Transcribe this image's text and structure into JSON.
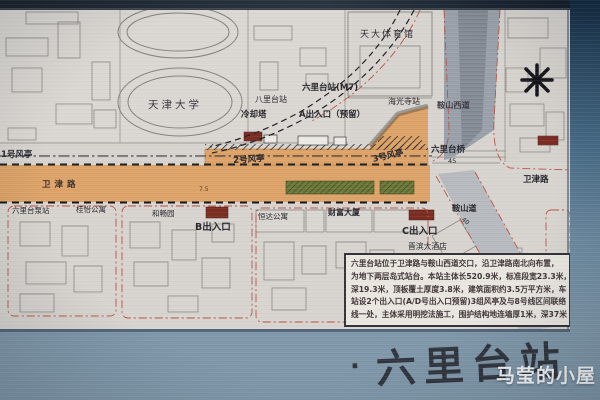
{
  "board": {
    "title_bullet": "·",
    "station_title": "六里台站",
    "watermark": "马莹的小屋"
  },
  "map": {
    "labels": {
      "tju_gym": "天大体育馆",
      "tianjin_university": "天津大学",
      "balitai_station": "八里台站",
      "liulitai_station": "六里台站(M7)",
      "haiguangsi_station": "海光寺站",
      "cooling_tower": "冷却塔",
      "entrance_a": "A出入口（预留）",
      "vent_1": "1号风亭",
      "vent_2": "2号风亭",
      "vent_3": "3号风亭",
      "liulitai_bridge": "六里台桥",
      "bridge_dim": "45",
      "anshan_west_road": "鞍山西道",
      "weijin_road_west": "卫津路",
      "weijin_road_east": "卫津路",
      "anshan_road": "鞍山道",
      "dim_75": "7.5",
      "dim_40": "40",
      "pump_station": "六里台泵站",
      "guiyi_apartment": "桂怡公寓",
      "hechang_garden": "和畅园",
      "entrance_b": "B出入口",
      "hengda_apartment": "恒达公寓",
      "caifu_building": "财富大厦",
      "entrance_c": "C出入口",
      "jinbin_hotel": "晋滨大酒店"
    },
    "info_box": {
      "line_1": "六里台站位于卫津路与鞍山西道交口，沿卫津路南北向布置，",
      "line_2": "为地下两层岛式站台。本站主体长520.9米，标准段宽23.3米，",
      "line_3": "深19.3米，顶板覆土厚度3.8米，建筑面积约3.5万平方米，车",
      "line_4": "站设2个出入口(A/D号出入口预留)3组风亭及与8号线区间联络",
      "line_5": "线一处，主体采用明挖法施工，围护结构地连墙厚1米，深37米"
    }
  },
  "colors": {
    "road_orange": "#dda368",
    "median_green": "#6d7a3b",
    "structure_red": "#7c2d22",
    "board_blue": "#7e96a9",
    "map_paper": "#d8d5d0"
  }
}
